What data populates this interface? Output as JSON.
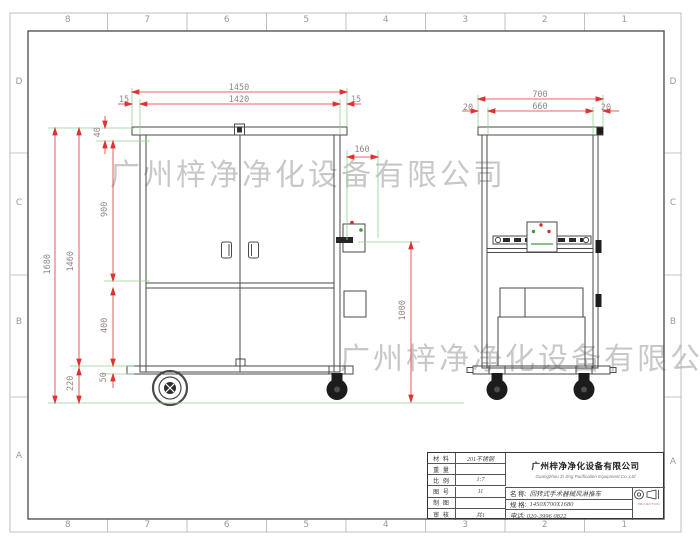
{
  "frame": {
    "top_numbers": [
      "8",
      "7",
      "6",
      "5",
      "4",
      "3",
      "2",
      "1"
    ],
    "bottom_numbers": [
      "8",
      "7",
      "6",
      "5",
      "4",
      "3",
      "2",
      "1"
    ],
    "left_letters": [
      "D",
      "C",
      "B",
      "A"
    ],
    "right_letters": [
      "D",
      "C",
      "B",
      "A"
    ]
  },
  "watermark": {
    "text": "广州梓净净化设备有限公司"
  },
  "front_view": {
    "dim_overall_width": "1450",
    "dim_inner_width": "1420",
    "dim_left_margin": "15",
    "dim_right_margin": "15",
    "dim_overall_height": "1680",
    "dim_body_height": "1460",
    "dim_top_cap": "40",
    "dim_door_height": "900",
    "dim_lower_section": "400",
    "dim_base": "50",
    "dim_wheel_clearance": "220",
    "dim_side_box": "160",
    "dim_right_height": "1000"
  },
  "side_view": {
    "dim_overall_depth": "700",
    "dim_inner_depth": "660",
    "dim_left_margin": "20",
    "dim_right_margin": "20"
  },
  "title_block": {
    "fields": [
      {
        "label": "材 料",
        "value": "201不锈钢"
      },
      {
        "label": "重 量",
        "value": ""
      },
      {
        "label": "比 例",
        "value": "1:7"
      },
      {
        "label": "图 号",
        "value": "11"
      },
      {
        "label": "制 图",
        "value": ""
      },
      {
        "label": "审 核",
        "value": "共1"
      }
    ],
    "company_cn": "广州梓净净化设备有限公司",
    "company_en": "Guangzhou Zi Jing Purification Equipment Co.,Ltd",
    "name_label": "名 称:",
    "name_value": "回转式手术器械风淋推车",
    "spec_label": "规 格:",
    "spec_value": "1450X700X1680",
    "phone": "电话: 020-3996 0822",
    "projection_label": "PROJECTION"
  },
  "colors": {
    "dimension_line": "#e03232",
    "extension_line": "#8fd48f",
    "dimension_text": "#968686",
    "drawing_line": "#4a4a4a",
    "watermark_gray": "#808080"
  }
}
